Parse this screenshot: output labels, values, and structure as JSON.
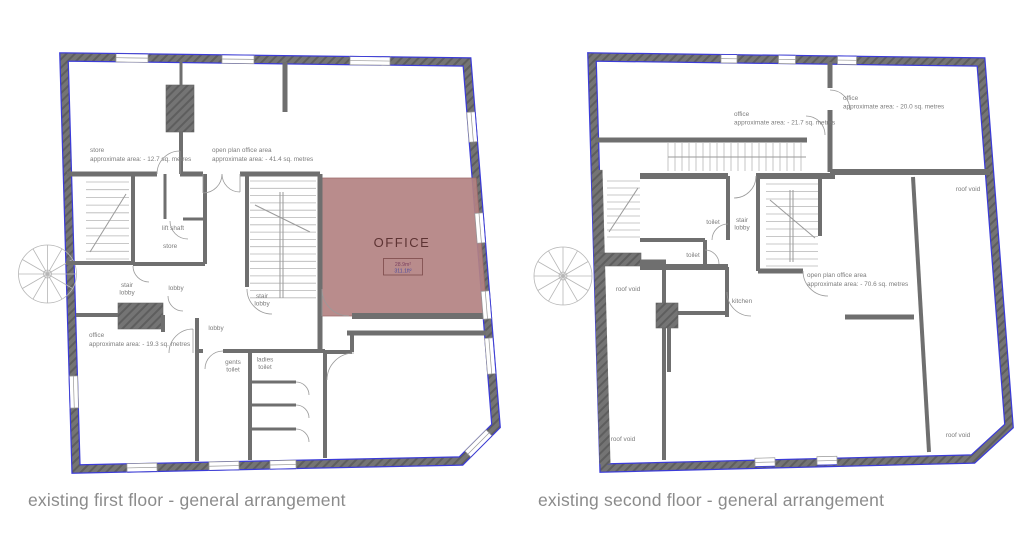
{
  "colors": {
    "wall": "#6f6f6f",
    "outline_blue": "#3b3bd8",
    "office_fill": "#b38282",
    "office_text": "#5d3333",
    "label_gray": "#7d7d7d",
    "caption_gray": "#8b8b8b",
    "area_m2_text": "#7b3f5e",
    "area_ft2_text": "#4b4b9e"
  },
  "captions": {
    "first": "existing first floor - general arrangement",
    "second": "existing second floor - general arrangement"
  },
  "first_floor": {
    "labels": {
      "store_name": "store",
      "store_area": "approximate area: - 12.7 sq. metres",
      "open_plan_name": "open plan office area",
      "open_plan_area": "approximate area: -  41.4 sq. metres",
      "lift_shaft": "lift shaft",
      "store2": "store",
      "stair1_l1": "stair",
      "stair1_l2": "lobby",
      "lobby1": "lobby",
      "stair2_l1": "stair",
      "stair2_l2": "lobby",
      "lobby2": "lobby",
      "office_name": "office",
      "office_area": "approximate area: - 19.3 sq. metres",
      "gents_l1": "gents",
      "gents_l2": "toilet",
      "ladies_l1": "ladies",
      "ladies_l2": "toilet",
      "office_room": "OFFICE",
      "office_m2": "28.9m²",
      "office_ft2": "311.1ft²"
    }
  },
  "second_floor": {
    "labels": {
      "office20_name": "office",
      "office20_area": "approximate area: - 20.0 sq. metres",
      "office21_name": "office",
      "office21_area": "approximate area: - 21.7 sq. metres",
      "roof_void_tr": "roof void",
      "toilet1": "toilet",
      "stair_l1": "stair",
      "stair_l2": "lobby",
      "toilet2": "toilet",
      "roof_void_left": "roof void",
      "kitchen": "kitchen",
      "open_plan_name": "open plan office area",
      "open_plan_area": "approximate area: - 70.6 sq. metres",
      "roof_void_bl": "roof void",
      "roof_void_br": "roof void"
    }
  }
}
